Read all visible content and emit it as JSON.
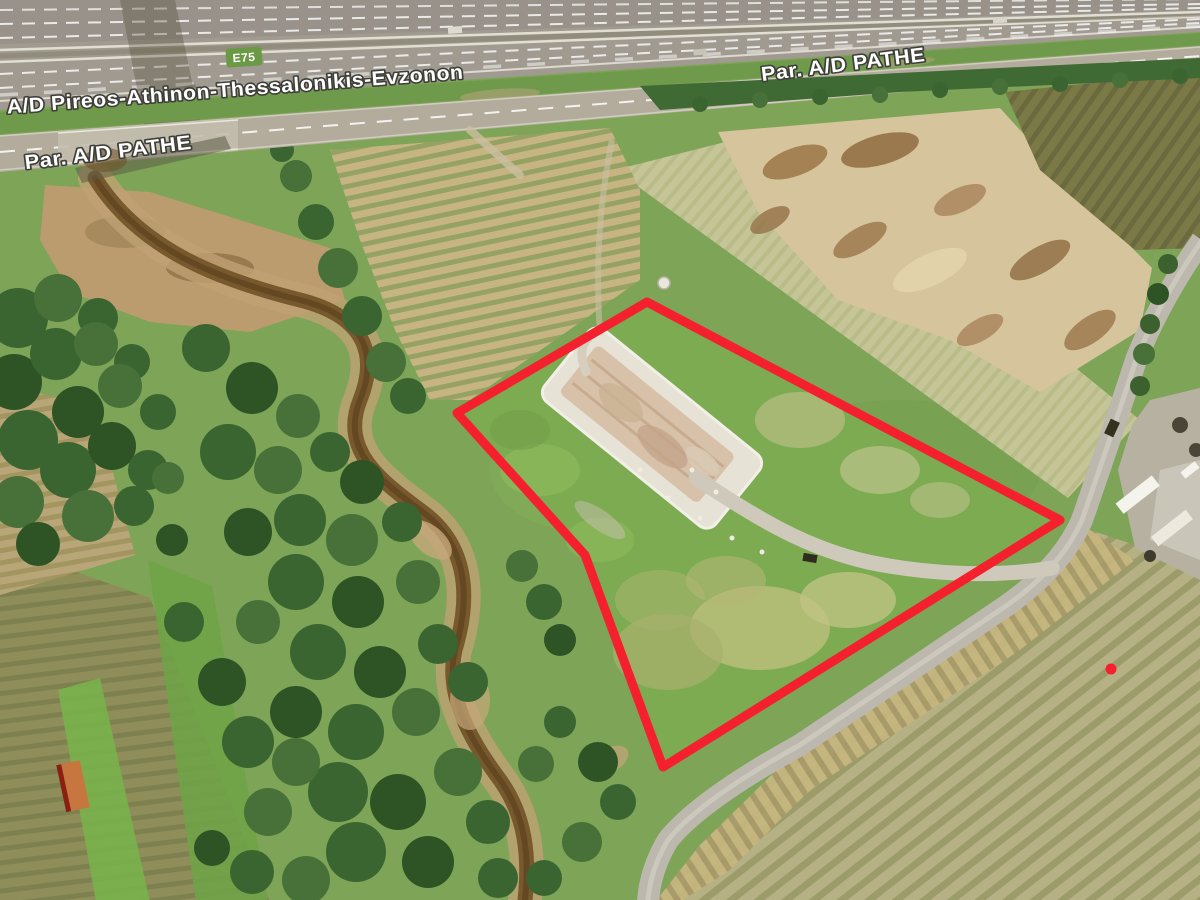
{
  "labels": {
    "motorway": "A/D Pireos-Athinon-Thessalonikis-Evzonon",
    "route_badge": "E75",
    "frontage_left": "Par. A/D PATHE",
    "frontage_right": "Par. A/D PATHE"
  },
  "colors": {
    "parcel_outline": "#f5202e",
    "marker_dot": "#f5202e",
    "route_badge_bg": "#6a9a44",
    "label_fill": "#ffffff",
    "label_outline": "#3f3f39"
  }
}
